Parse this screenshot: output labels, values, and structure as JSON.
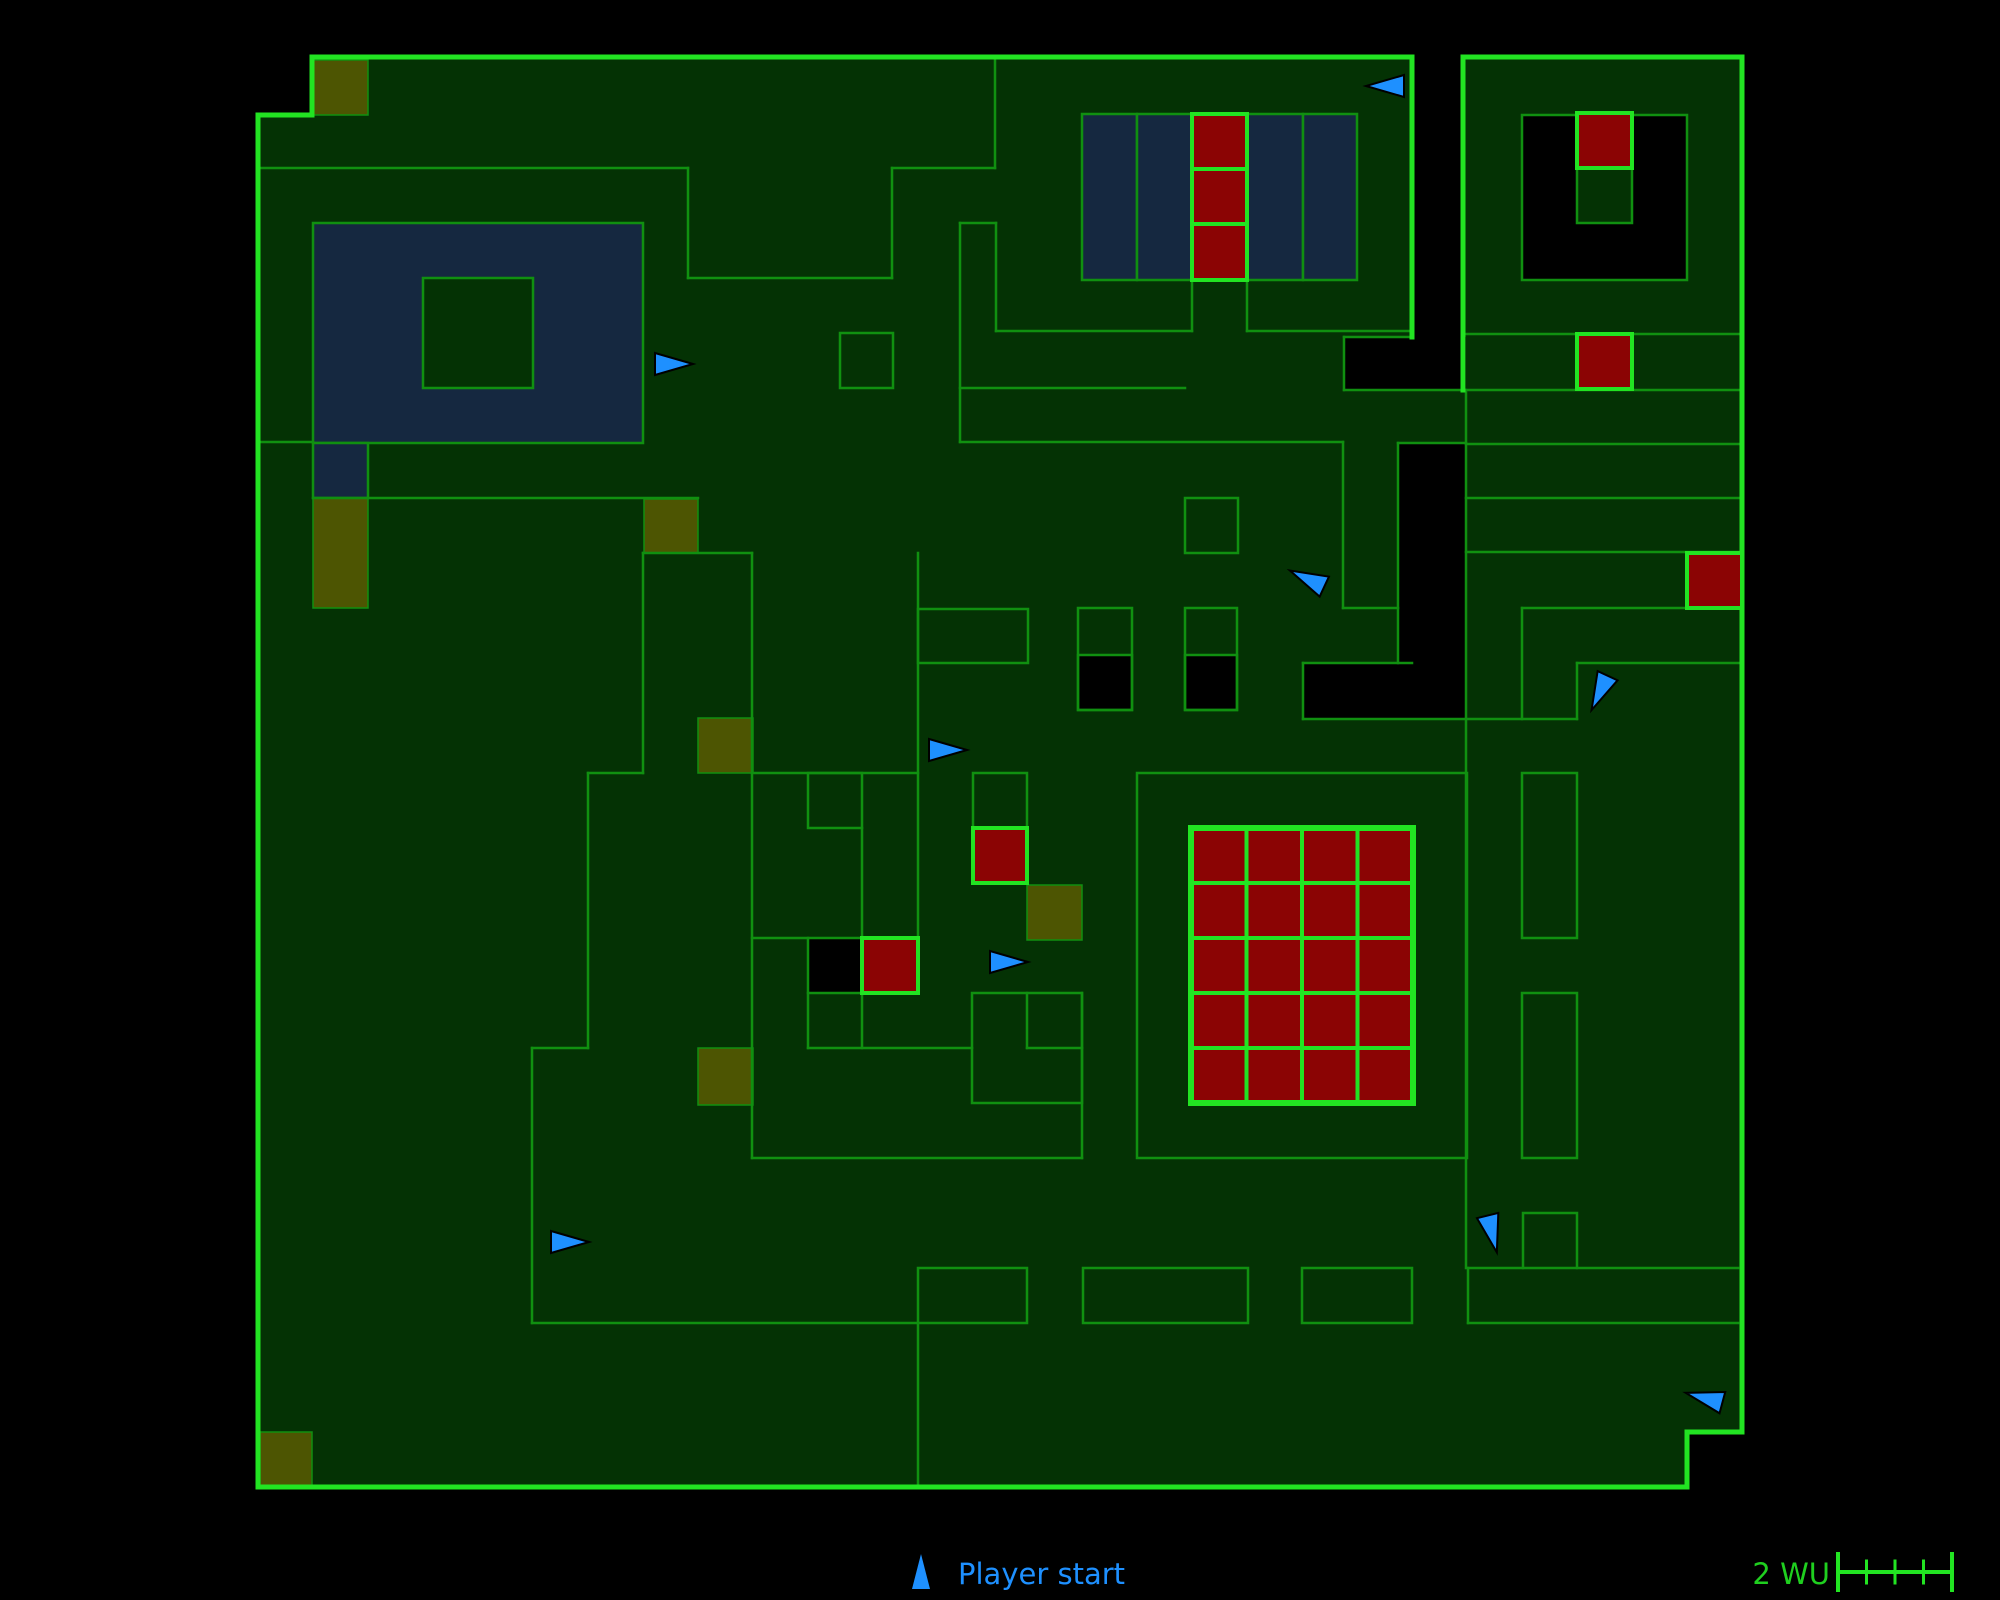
{
  "legend": {
    "player_start_label": "Player start",
    "scale_label": "2 WU"
  },
  "colors": {
    "background": "#000000",
    "floor": "#043204",
    "wall_dim": "#109010",
    "wall_bright": "#22e422",
    "navy": "#152840",
    "olive": "#4d5502",
    "red": "#8b0404",
    "black": "#000000",
    "arrow_fill": "#1e90ff",
    "arrow_stroke": "#000000",
    "legend_text": "#1e90ff",
    "scale_text": "#1fcf1f"
  },
  "map": {
    "width": 2000,
    "height": 1600,
    "floors": [
      {
        "x": 258,
        "y": 57,
        "w": 1429,
        "h": 1430
      },
      {
        "x": 1687,
        "y": 57,
        "w": 55,
        "h": 1375
      }
    ],
    "black_holes": [
      {
        "x": 258,
        "y": 57,
        "w": 54,
        "h": 58
      },
      {
        "x": 1412,
        "y": 57,
        "w": 51,
        "h": 280
      },
      {
        "x": 1344,
        "y": 337,
        "w": 122,
        "h": 53
      },
      {
        "x": 1398,
        "y": 443,
        "w": 68,
        "h": 220
      },
      {
        "x": 1303,
        "y": 663,
        "w": 163,
        "h": 56
      },
      {
        "x": 1522,
        "y": 115,
        "w": 165,
        "h": 165
      }
    ],
    "navy_areas": [
      {
        "x": 313,
        "y": 223,
        "w": 330,
        "h": 220
      },
      {
        "x": 313,
        "y": 443,
        "w": 55,
        "h": 55
      },
      {
        "x": 1082,
        "y": 114,
        "w": 55,
        "h": 166
      },
      {
        "x": 1137,
        "y": 114,
        "w": 55,
        "h": 166
      },
      {
        "x": 1247,
        "y": 114,
        "w": 56,
        "h": 166
      },
      {
        "x": 1303,
        "y": 114,
        "w": 54,
        "h": 166
      }
    ],
    "green_patches": [
      {
        "x": 423,
        "y": 278,
        "w": 110,
        "h": 110
      },
      {
        "x": 1577,
        "y": 168,
        "w": 55,
        "h": 55
      }
    ],
    "olive_squares": [
      {
        "x": 313,
        "y": 60,
        "w": 55,
        "h": 55
      },
      {
        "x": 313,
        "y": 498,
        "w": 55,
        "h": 110
      },
      {
        "x": 644,
        "y": 499,
        "w": 54,
        "h": 54
      },
      {
        "x": 698,
        "y": 718,
        "w": 55,
        "h": 55
      },
      {
        "x": 698,
        "y": 1048,
        "w": 55,
        "h": 57
      },
      {
        "x": 260,
        "y": 1432,
        "w": 52,
        "h": 55
      },
      {
        "x": 1027,
        "y": 885,
        "w": 55,
        "h": 55
      }
    ],
    "black_cells": [
      {
        "x": 808,
        "y": 938,
        "w": 54,
        "h": 55
      },
      {
        "x": 1078,
        "y": 655,
        "w": 54,
        "h": 55
      },
      {
        "x": 1185,
        "y": 655,
        "w": 52,
        "h": 55
      }
    ],
    "dim_rects": [
      {
        "x": 840,
        "y": 333,
        "w": 53,
        "h": 55
      },
      {
        "x": 1185,
        "y": 498,
        "w": 53,
        "h": 55
      },
      {
        "x": 1522,
        "y": 115,
        "w": 165,
        "h": 165
      },
      {
        "x": 1137,
        "y": 773,
        "w": 330,
        "h": 385
      },
      {
        "x": 918,
        "y": 609,
        "w": 110,
        "h": 54
      },
      {
        "x": 918,
        "y": 1268,
        "w": 109,
        "h": 55
      },
      {
        "x": 1083,
        "y": 1268,
        "w": 165,
        "h": 55
      },
      {
        "x": 1302,
        "y": 1268,
        "w": 110,
        "h": 55
      },
      {
        "x": 1523,
        "y": 1213,
        "w": 54,
        "h": 55
      },
      {
        "x": 1522,
        "y": 773,
        "w": 55,
        "h": 165
      },
      {
        "x": 1522,
        "y": 993,
        "w": 55,
        "h": 165
      },
      {
        "x": 808,
        "y": 773,
        "w": 54,
        "h": 55
      },
      {
        "x": 973,
        "y": 773,
        "w": 54,
        "h": 55
      },
      {
        "x": 972,
        "y": 993,
        "w": 110,
        "h": 110
      },
      {
        "x": 1078,
        "y": 608,
        "w": 54,
        "h": 102
      },
      {
        "x": 1185,
        "y": 608,
        "w": 52,
        "h": 102
      }
    ],
    "dim_segments": [
      [
        258,
        168,
        688,
        168
      ],
      [
        688,
        168,
        688,
        278
      ],
      [
        688,
        278,
        892,
        278
      ],
      [
        892,
        168,
        892,
        278
      ],
      [
        892,
        168,
        995,
        168
      ],
      [
        995,
        57,
        995,
        168
      ],
      [
        258,
        442,
        313,
        442
      ],
      [
        313,
        498,
        698,
        498
      ],
      [
        643,
        553,
        752,
        553
      ],
      [
        643,
        553,
        643,
        773
      ],
      [
        588,
        773,
        643,
        773
      ],
      [
        588,
        773,
        588,
        1048
      ],
      [
        532,
        1048,
        588,
        1048
      ],
      [
        532,
        1048,
        532,
        1323
      ],
      [
        532,
        1323,
        918,
        1323
      ],
      [
        918,
        1323,
        918,
        1487
      ],
      [
        752,
        553,
        752,
        1158
      ],
      [
        752,
        773,
        918,
        773
      ],
      [
        918,
        553,
        918,
        938
      ],
      [
        752,
        1158,
        1082,
        1158
      ],
      [
        862,
        828,
        862,
        938
      ],
      [
        752,
        938,
        808,
        938
      ],
      [
        808,
        993,
        808,
        1048
      ],
      [
        862,
        993,
        862,
        1048
      ],
      [
        808,
        1048,
        972,
        1048
      ],
      [
        1027,
        993,
        1027,
        1048
      ],
      [
        1027,
        1048,
        1082,
        1048
      ],
      [
        1082,
        993,
        1082,
        1158
      ],
      [
        960,
        223,
        960,
        442
      ],
      [
        960,
        223,
        996,
        223
      ],
      [
        996,
        223,
        996,
        331
      ],
      [
        996,
        331,
        1192,
        331
      ],
      [
        1247,
        331,
        1412,
        331
      ],
      [
        1192,
        280,
        1192,
        331
      ],
      [
        1247,
        280,
        1247,
        331
      ],
      [
        960,
        388,
        1185,
        388
      ],
      [
        960,
        442,
        1343,
        442
      ],
      [
        1343,
        442,
        1343,
        608
      ],
      [
        1343,
        608,
        1398,
        608
      ],
      [
        1344,
        337,
        1412,
        337
      ],
      [
        1344,
        337,
        1344,
        390
      ],
      [
        1344,
        390,
        1463,
        390
      ],
      [
        1398,
        443,
        1466,
        443
      ],
      [
        1398,
        443,
        1398,
        663
      ],
      [
        1303,
        663,
        1412,
        663
      ],
      [
        1303,
        663,
        1303,
        719
      ],
      [
        1303,
        719,
        1577,
        719
      ],
      [
        1577,
        663,
        1577,
        719
      ],
      [
        1577,
        663,
        1742,
        663
      ],
      [
        1466,
        390,
        1466,
        719
      ],
      [
        1466,
        444,
        1742,
        444
      ],
      [
        1466,
        498,
        1742,
        498
      ],
      [
        1466,
        552,
        1742,
        552
      ],
      [
        1522,
        608,
        1687,
        608
      ],
      [
        1522,
        608,
        1522,
        719
      ],
      [
        1466,
        719,
        1466,
        1268
      ],
      [
        1466,
        334,
        1742,
        334
      ],
      [
        1466,
        390,
        1742,
        390
      ],
      [
        1468,
        1268,
        1523,
        1268
      ],
      [
        1577,
        1268,
        1738,
        1268
      ],
      [
        1468,
        1323,
        1738,
        1323
      ],
      [
        1468,
        1268,
        1468,
        1323
      ]
    ],
    "bright_segments": [
      [
        312,
        57,
        1412,
        57
      ],
      [
        312,
        57,
        312,
        115
      ],
      [
        258,
        115,
        312,
        115
      ],
      [
        258,
        115,
        258,
        1487
      ],
      [
        258,
        1487,
        1687,
        1487
      ],
      [
        1687,
        1432,
        1687,
        1487
      ],
      [
        1687,
        1432,
        1742,
        1432
      ],
      [
        1742,
        57,
        1742,
        1432
      ],
      [
        1463,
        57,
        1742,
        57
      ],
      [
        1412,
        57,
        1412,
        337
      ],
      [
        1463,
        57,
        1463,
        390
      ]
    ],
    "red_cells": [
      {
        "x": 1192,
        "y": 114,
        "w": 55,
        "h": 55
      },
      {
        "x": 1192,
        "y": 169,
        "w": 55,
        "h": 55
      },
      {
        "x": 1192,
        "y": 224,
        "w": 55,
        "h": 56
      },
      {
        "x": 1577,
        "y": 113,
        "w": 55,
        "h": 55
      },
      {
        "x": 1577,
        "y": 334,
        "w": 55,
        "h": 55
      },
      {
        "x": 1687,
        "y": 553,
        "w": 55,
        "h": 55
      },
      {
        "x": 973,
        "y": 828,
        "w": 54,
        "h": 55
      },
      {
        "x": 862,
        "y": 938,
        "w": 56,
        "h": 55
      }
    ],
    "red_grid": {
      "x": 1191,
      "y": 828,
      "cols": 4,
      "rows": 5,
      "cw": 55.5,
      "ch": 55
    },
    "arrows": [
      {
        "x": 673,
        "y": 364,
        "a": 0
      },
      {
        "x": 1386,
        "y": 86,
        "a": 180
      },
      {
        "x": 1308,
        "y": 579,
        "a": 205
      },
      {
        "x": 947,
        "y": 750,
        "a": 0
      },
      {
        "x": 1600,
        "y": 692,
        "a": 115
      },
      {
        "x": 1008,
        "y": 962,
        "a": 0
      },
      {
        "x": 569,
        "y": 1242,
        "a": 0
      },
      {
        "x": 1492,
        "y": 1233,
        "a": 76
      },
      {
        "x": 1705,
        "y": 1398,
        "a": 195
      }
    ]
  }
}
